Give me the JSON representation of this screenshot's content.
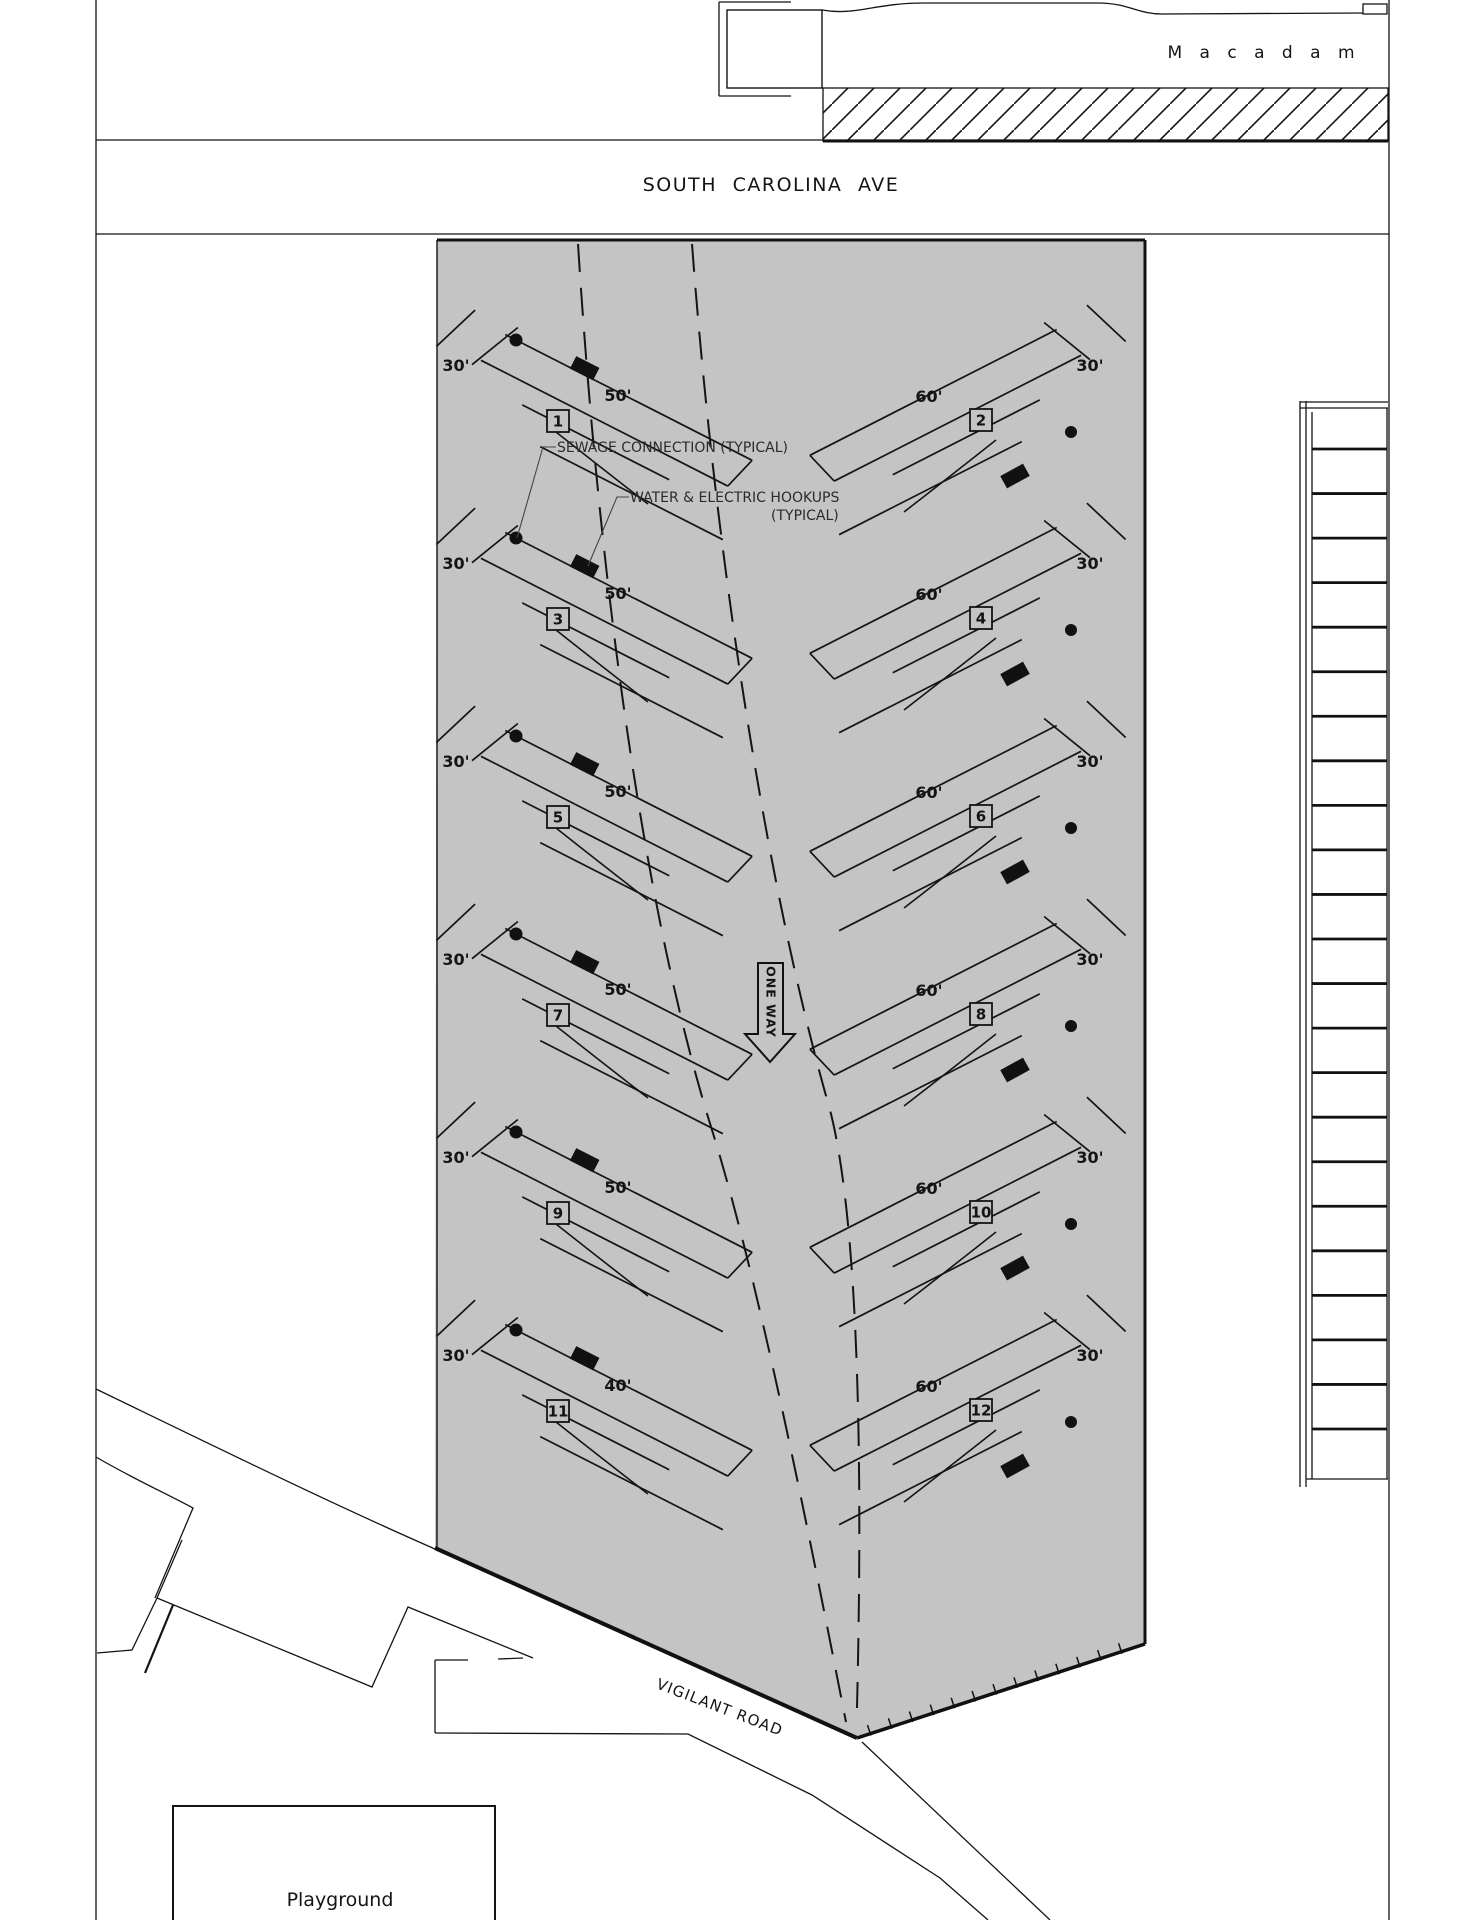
{
  "page": {
    "background": "#ffffff",
    "line_color": "#141414",
    "site_fill": "#c4c4c4"
  },
  "streets": {
    "north_road": "M a c a d a m",
    "main_street": "SOUTH CAROLINA AVE",
    "south_road": "VIGILANT ROAD"
  },
  "annotations": {
    "sewage": "SEWAGE CONNECTION (TYPICAL)",
    "hookups_line1": "WATER & ELECTRIC HOOKUPS",
    "hookups_line2": "(TYPICAL)",
    "one_way": "ONE WAY",
    "playground": "Playground"
  },
  "campsites": [
    {
      "number": "1",
      "side": "left",
      "row": 0,
      "end_label": "30'",
      "length_label": "50'"
    },
    {
      "number": "2",
      "side": "right",
      "row": 0,
      "end_label": "30'",
      "length_label": "60'"
    },
    {
      "number": "3",
      "side": "left",
      "row": 1,
      "end_label": "30'",
      "length_label": "50'"
    },
    {
      "number": "4",
      "side": "right",
      "row": 1,
      "end_label": "30'",
      "length_label": "60'"
    },
    {
      "number": "5",
      "side": "left",
      "row": 2,
      "end_label": "30'",
      "length_label": "50'"
    },
    {
      "number": "6",
      "side": "right",
      "row": 2,
      "end_label": "30'",
      "length_label": "60'"
    },
    {
      "number": "7",
      "side": "left",
      "row": 3,
      "end_label": "30'",
      "length_label": "50'"
    },
    {
      "number": "8",
      "side": "right",
      "row": 3,
      "end_label": "30'",
      "length_label": "60'"
    },
    {
      "number": "9",
      "side": "left",
      "row": 4,
      "end_label": "30'",
      "length_label": "50'"
    },
    {
      "number": "10",
      "side": "right",
      "row": 4,
      "end_label": "30'",
      "length_label": "60'"
    },
    {
      "number": "11",
      "side": "left",
      "row": 5,
      "end_label": "30'",
      "length_label": "40'"
    },
    {
      "number": "12",
      "side": "right",
      "row": 5,
      "end_label": "30'",
      "length_label": "60'"
    }
  ],
  "east_parking": {
    "stall_rows": 22
  }
}
